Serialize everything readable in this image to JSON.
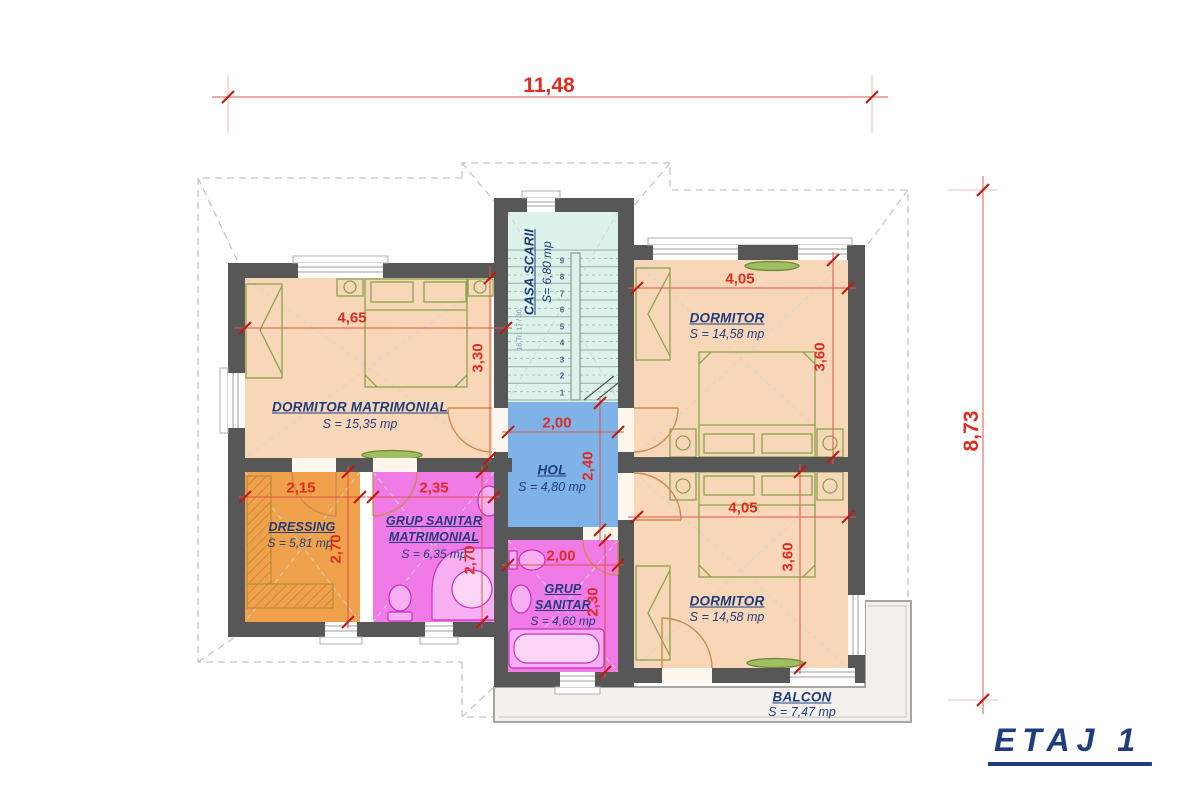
{
  "title": {
    "label": "ETAJ 1"
  },
  "overall": {
    "width_label": "11,48",
    "height_label": "8,73"
  },
  "rooms": {
    "dormitor_matrimonial": {
      "name": "DORMITOR MATRIMONIAL",
      "area": "S = 15,35 mp",
      "width": "4,65",
      "height": "3,30"
    },
    "casa_scarii": {
      "name": "CASA SCARII",
      "area": "S= 6,80 mp",
      "stair_note": "18 Tr: 17 / 30",
      "stair_numbers": [
        "1",
        "2",
        "3",
        "4",
        "5",
        "6",
        "7",
        "8",
        "9"
      ]
    },
    "dormitor_nord": {
      "name": "DORMITOR",
      "area": "S = 14,58 mp",
      "width": "4,05",
      "height": "3,60"
    },
    "dormitor_sud": {
      "name": "DORMITOR",
      "area": "S = 14,58 mp",
      "width": "4,05",
      "height": "3,60"
    },
    "hol": {
      "name": "HOL",
      "area": "S = 4,80 mp",
      "width": "2,00",
      "height": "2,40"
    },
    "dressing": {
      "name": "DRESSING",
      "area": "S = 5,81 mp",
      "width": "2,15",
      "height": "2,70"
    },
    "grup_sanitar_matrimonial": {
      "name_line1": "GRUP SANITAR",
      "name_line2": "MATRIMONIAL",
      "area": "S = 6,35 mp",
      "width": "2,35",
      "height": "2,70"
    },
    "grup_sanitar": {
      "name_line1": "GRUP",
      "name_line2": "SANITAR",
      "area": "S = 4,60 mp",
      "width": "2,00",
      "height": "2,30"
    },
    "balcon": {
      "name": "BALCON",
      "area": "S = 7,47 mp"
    }
  },
  "colors": {
    "wall": "#575757",
    "bedroom_fill": "#f7d7b8",
    "staircase_fill": "#dcf2ea",
    "hall_fill": "#7fb2e6",
    "dressing_fill": "#efa14b",
    "bathroom_fill": "#f07ae6",
    "balcony_fill": "#f4f1ed",
    "dimension_red": "#e02b20",
    "label_navy": "#1f3d7e",
    "furniture_green": "#8da24e",
    "sanitary_magenta": "#cb2ec0",
    "door_arc": "#cf8a50"
  }
}
